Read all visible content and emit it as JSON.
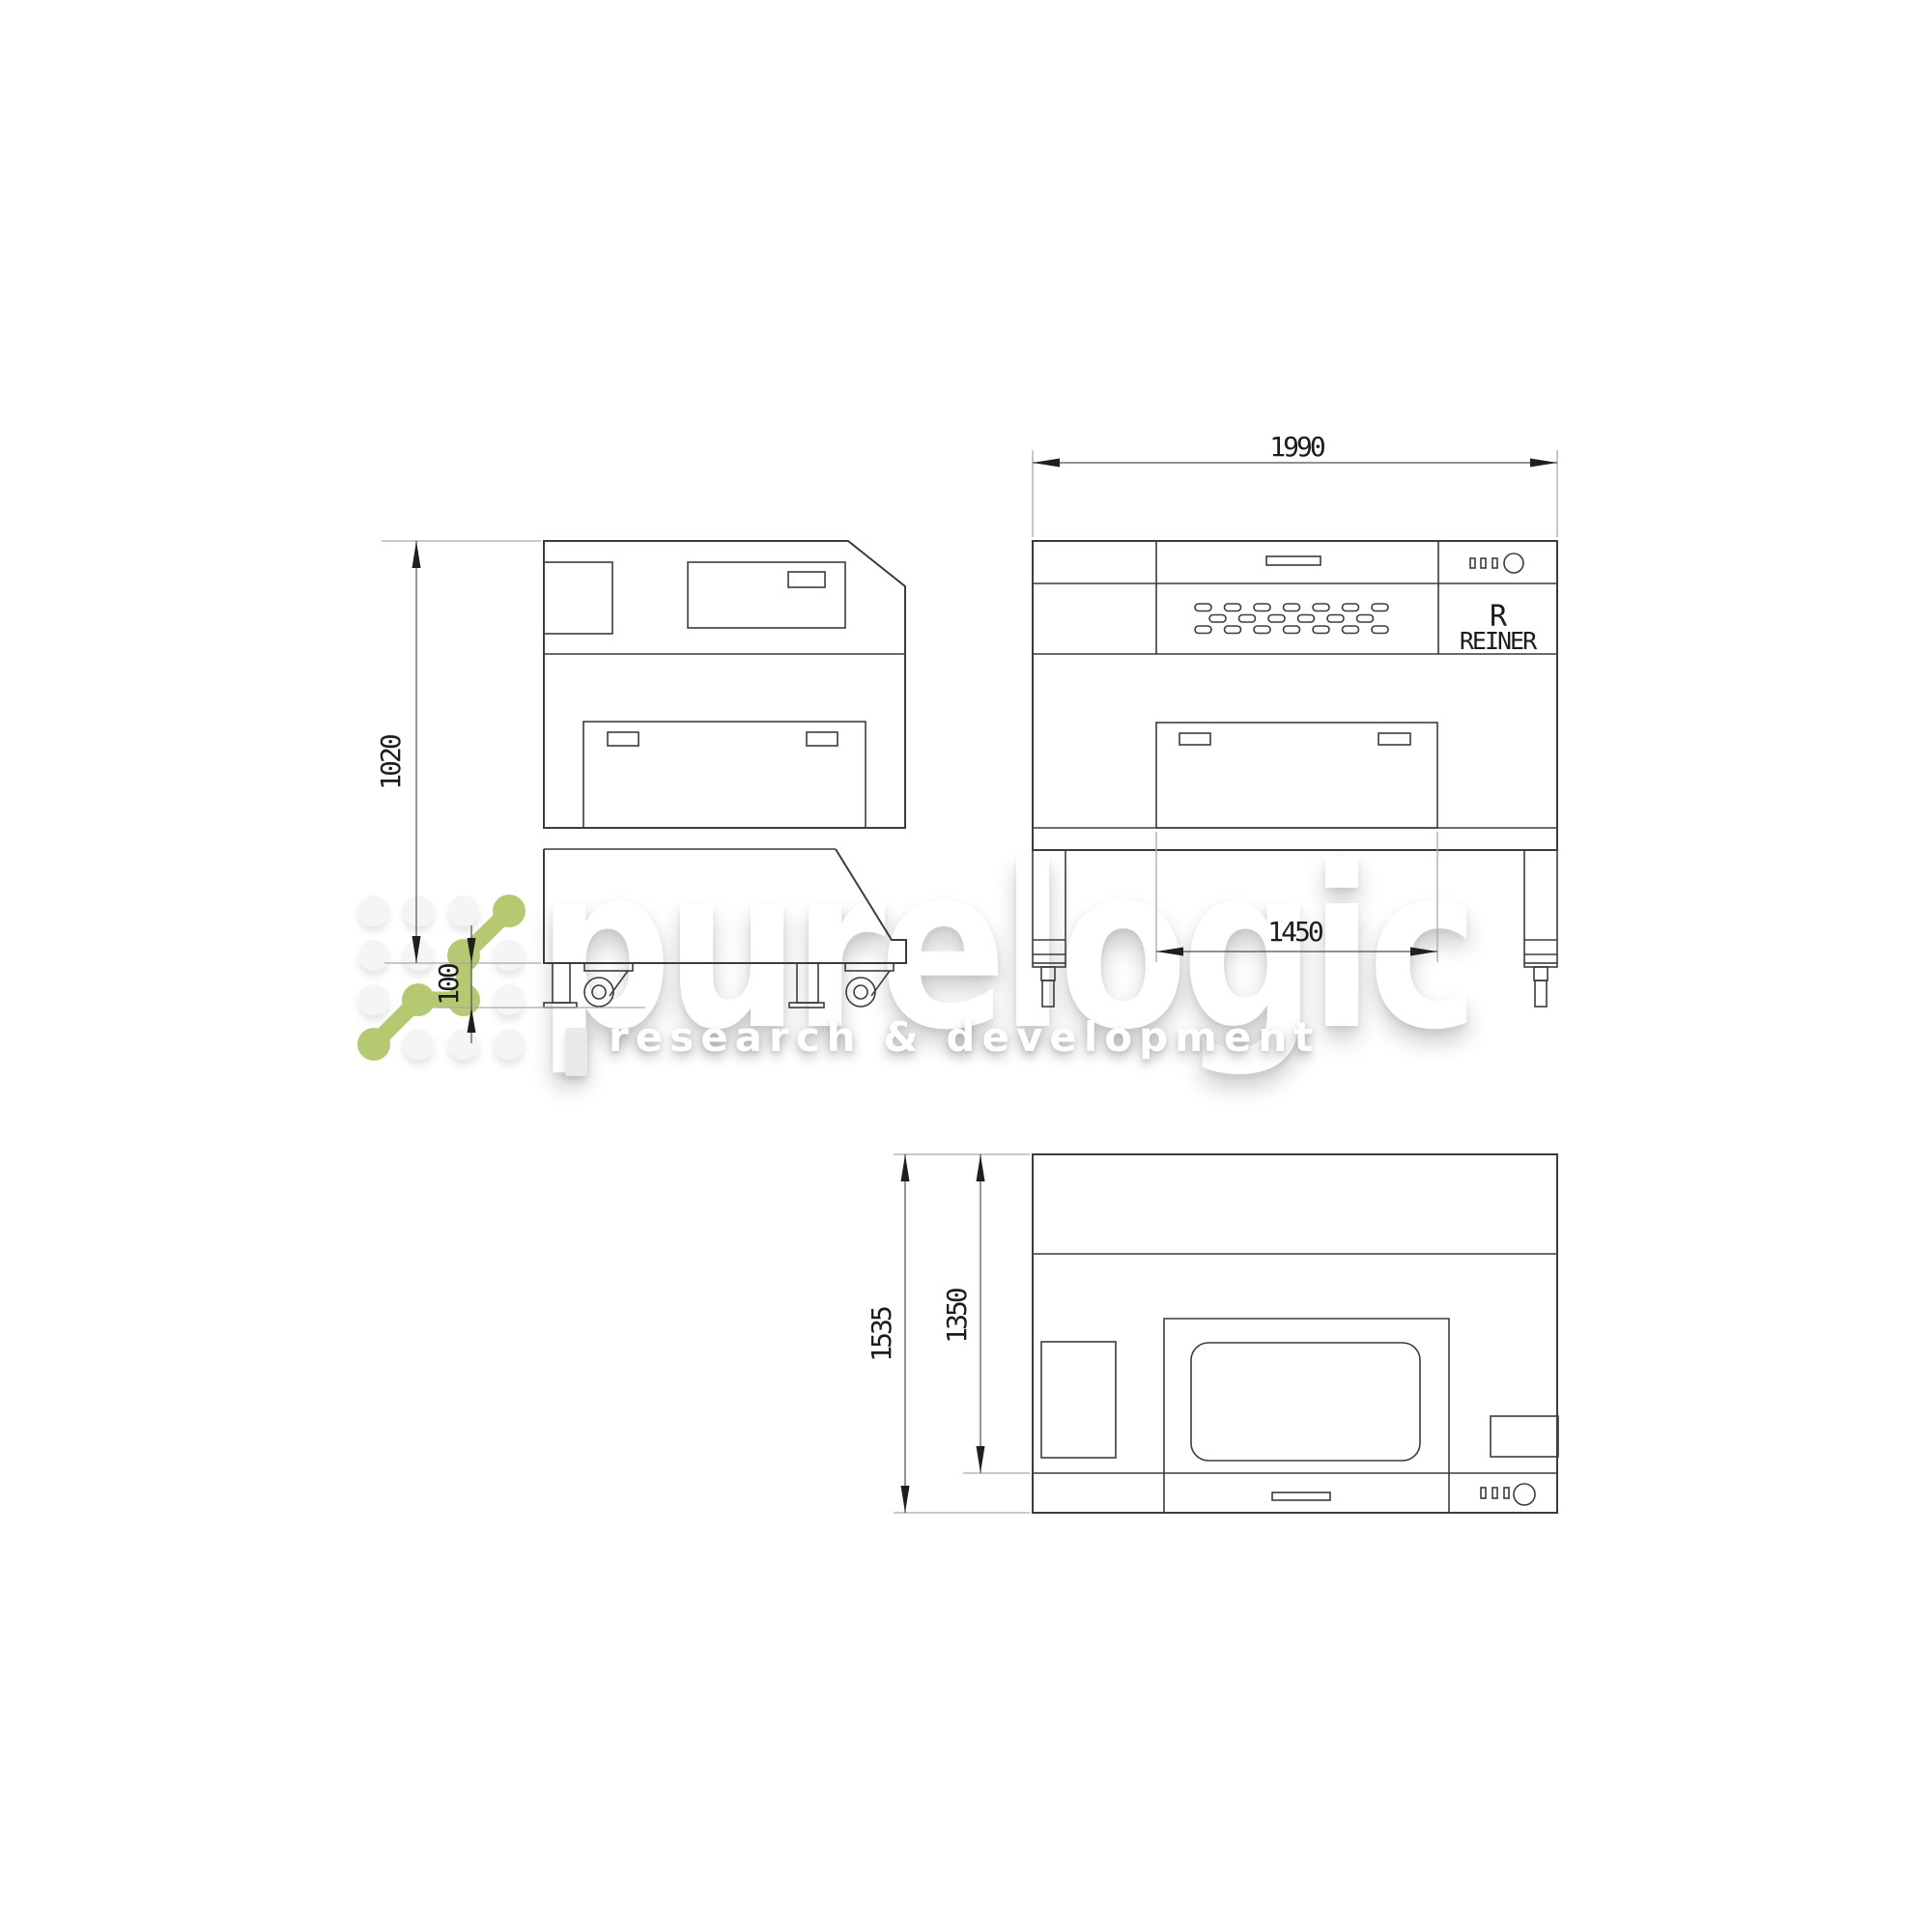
{
  "page": {
    "background_color": "#ffffff"
  },
  "watermark": {
    "brand": "purelogic",
    "tagline": "research & development",
    "green_color": "#b5c973",
    "dot_color": "#f5f5f5"
  },
  "drawing": {
    "line_color": "#3c3c3c",
    "dim_line_color": "#4f4f4f",
    "extension_line_color": "#a9a9a9",
    "text_color": "#1c1c1c"
  },
  "brand_plate": {
    "initial": "R",
    "name": "REINER"
  },
  "dimensions": {
    "side_height": "1020",
    "side_ground_clearance": "100",
    "front_width": "1990",
    "front_leg_span": "1450",
    "top_depth_overall": "1535",
    "top_depth_body": "1350"
  }
}
